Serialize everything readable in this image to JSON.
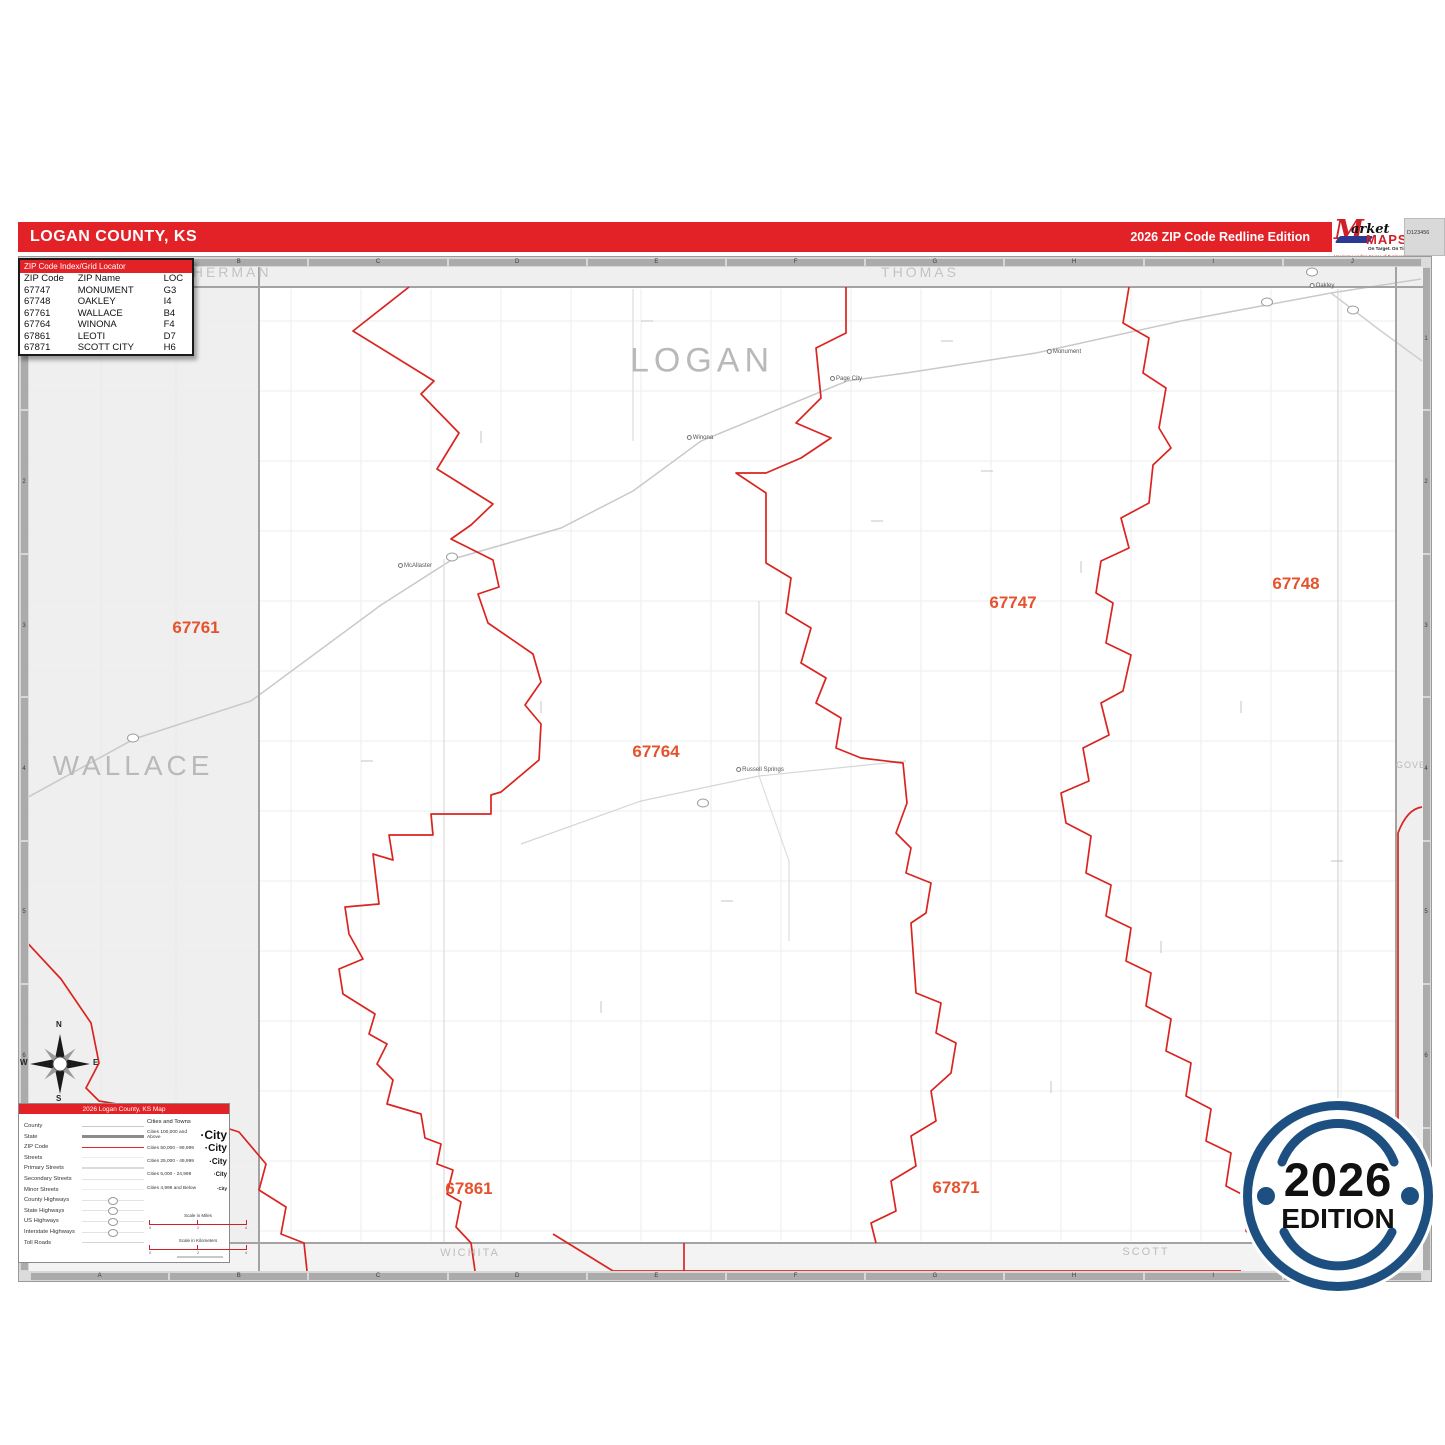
{
  "header": {
    "title": "LOGAN COUNTY, KS",
    "edition": "2026 ZIP Code Redline Edition",
    "bar_color": "#e32227"
  },
  "logo": {
    "brand_initial": "M",
    "brand_rest": "arket",
    "brand_bottom": "MAPS",
    "tagline": "On Target.  On Time.",
    "subtitle": "America's Leading Source of Business Maps",
    "product_code": "D123456"
  },
  "index_table": {
    "title": "ZIP Code Index/Grid Locator",
    "columns": [
      "ZIP Code",
      "ZIP Name",
      "LOC"
    ],
    "rows": [
      [
        "67747",
        "MONUMENT",
        "G3"
      ],
      [
        "67748",
        "OAKLEY",
        "I4"
      ],
      [
        "67761",
        "WALLACE",
        "B4"
      ],
      [
        "67764",
        "WINONA",
        "F4"
      ],
      [
        "67861",
        "LEOTI",
        "D7"
      ],
      [
        "67871",
        "SCOTT CITY",
        "H6"
      ]
    ]
  },
  "map": {
    "grid_letters": [
      "A",
      "B",
      "C",
      "D",
      "E",
      "F",
      "G",
      "H",
      "I",
      "J"
    ],
    "grid_numbers": [
      "1",
      "2",
      "3",
      "4",
      "5",
      "6",
      "7"
    ],
    "zip_line_color": "#da2420",
    "zip_label_color": "#e4532d",
    "county_labels": [
      {
        "name": "LOGAN",
        "x": 702,
        "y": 361,
        "cls": "cl-xl"
      },
      {
        "name": "WALLACE",
        "x": 133,
        "y": 766,
        "cls": "cl-lg"
      },
      {
        "name": "SHERMAN",
        "x": 226,
        "y": 272,
        "cls": "cl-md"
      },
      {
        "name": "THOMAS",
        "x": 920,
        "y": 272,
        "cls": "cl-md"
      },
      {
        "name": "GOVE",
        "x": 1411,
        "y": 765,
        "cls": "cl-sm"
      },
      {
        "name": "WICHITA",
        "x": 470,
        "y": 1253,
        "cls": "cl-sm2"
      },
      {
        "name": "SCOTT",
        "x": 1146,
        "y": 1252,
        "cls": "cl-sm2"
      }
    ],
    "zip_labels": [
      {
        "code": "67761",
        "x": 196,
        "y": 628
      },
      {
        "code": "67747",
        "x": 1013,
        "y": 603
      },
      {
        "code": "67748",
        "x": 1296,
        "y": 584
      },
      {
        "code": "67764",
        "x": 656,
        "y": 752
      },
      {
        "code": "67861",
        "x": 469,
        "y": 1189
      },
      {
        "code": "67871",
        "x": 956,
        "y": 1188
      }
    ],
    "towns": [
      {
        "name": "McAllaster",
        "x": 415,
        "y": 566
      },
      {
        "name": "Winona",
        "x": 700,
        "y": 438
      },
      {
        "name": "Page City",
        "x": 846,
        "y": 379
      },
      {
        "name": "Monument",
        "x": 1064,
        "y": 352
      },
      {
        "name": "Oakley",
        "x": 1322,
        "y": 286
      },
      {
        "name": "Russell Springs",
        "x": 760,
        "y": 770
      }
    ],
    "shields": [
      {
        "x": 133,
        "y": 738
      },
      {
        "x": 452,
        "y": 557
      },
      {
        "x": 703,
        "y": 803
      },
      {
        "x": 1267,
        "y": 302
      },
      {
        "x": 1312,
        "y": 272
      },
      {
        "x": 1353,
        "y": 310
      }
    ]
  },
  "compass": {
    "n": "N",
    "s": "S",
    "e": "E",
    "w": "W"
  },
  "legend": {
    "title": "2026 Logan County, KS Map",
    "items": [
      {
        "label": "County",
        "type": "s-county"
      },
      {
        "label": "State",
        "type": "s-state"
      },
      {
        "label": "ZIP Code",
        "type": "s-zip"
      },
      {
        "label": "Streets",
        "type": "s-street"
      },
      {
        "label": "Primary Streets",
        "type": "s-primary"
      },
      {
        "label": "Secondary Streets",
        "type": "s-secondary"
      },
      {
        "label": "Minor Streets",
        "type": "s-minor"
      },
      {
        "label": "County Highways",
        "type": "s-secondary",
        "shield": true
      },
      {
        "label": "State Highways",
        "type": "s-secondary",
        "shield": true
      },
      {
        "label": "US Highways",
        "type": "s-secondary",
        "shield": true
      },
      {
        "label": "Interstate Highways",
        "type": "s-secondary",
        "shield": true
      },
      {
        "label": "Toll Roads",
        "type": "s-toll"
      }
    ],
    "cities_header": "Cities and Towns",
    "cities": [
      {
        "label": "Cities 100,000 and Above",
        "sample": "·City",
        "size": 12
      },
      {
        "label": "Cities 50,000 - 99,999",
        "sample": "·City",
        "size": 10
      },
      {
        "label": "Cities 25,000 - 49,999",
        "sample": "·City",
        "size": 8
      },
      {
        "label": "Cities 5,000 - 24,999",
        "sample": "·City",
        "size": 6
      },
      {
        "label": "Cities 4,999 and Below",
        "sample": "·City",
        "size": 4.5
      }
    ],
    "scale_miles_label": "Scale in Miles",
    "scale_km_label": "Scale in Kilometers",
    "scale_ticks": [
      "0",
      "2",
      "4"
    ]
  },
  "badge": {
    "year": "2026",
    "label": "EDITION",
    "ring_color": "#1d5080"
  }
}
